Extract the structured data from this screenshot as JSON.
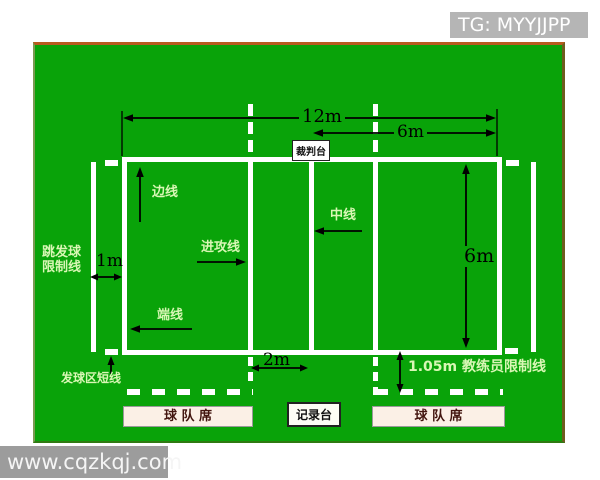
{
  "overlays": {
    "tg_badge": "TG: MYYJJPP",
    "watermark": "www.cqzkqj.com"
  },
  "stations": {
    "referee_stand": "裁判台",
    "recorder_table": "记录台",
    "team_bench_left": "球 队 席",
    "team_bench_right": "球 队 席"
  },
  "line_labels": {
    "sideline": "边线",
    "attack_line": "进攻线",
    "center_line": "中线",
    "end_line": "端线",
    "jump_serve_limit_1": "跳发球",
    "jump_serve_limit_2": "限制线",
    "serve_zone_short_line": "发球区短线",
    "coach_limit_line": "1.05m 教练员限制线"
  },
  "dimensions": {
    "court_length": "12m",
    "half_court_length": "6m",
    "court_width": "6m",
    "serve_limit_offset": "1m",
    "attack_line_distance": "2m"
  },
  "colors": {
    "field_green": "#09a309",
    "label_green": "#d9f7b5",
    "court_line_white": "#ffffff",
    "arrow_black": "#000000",
    "badge_gray": "#b5b5b5",
    "watermark_gray": "#9c9c9c",
    "bench_fill": "#fbf0e6",
    "field_border_orange": "#b75b1f"
  }
}
